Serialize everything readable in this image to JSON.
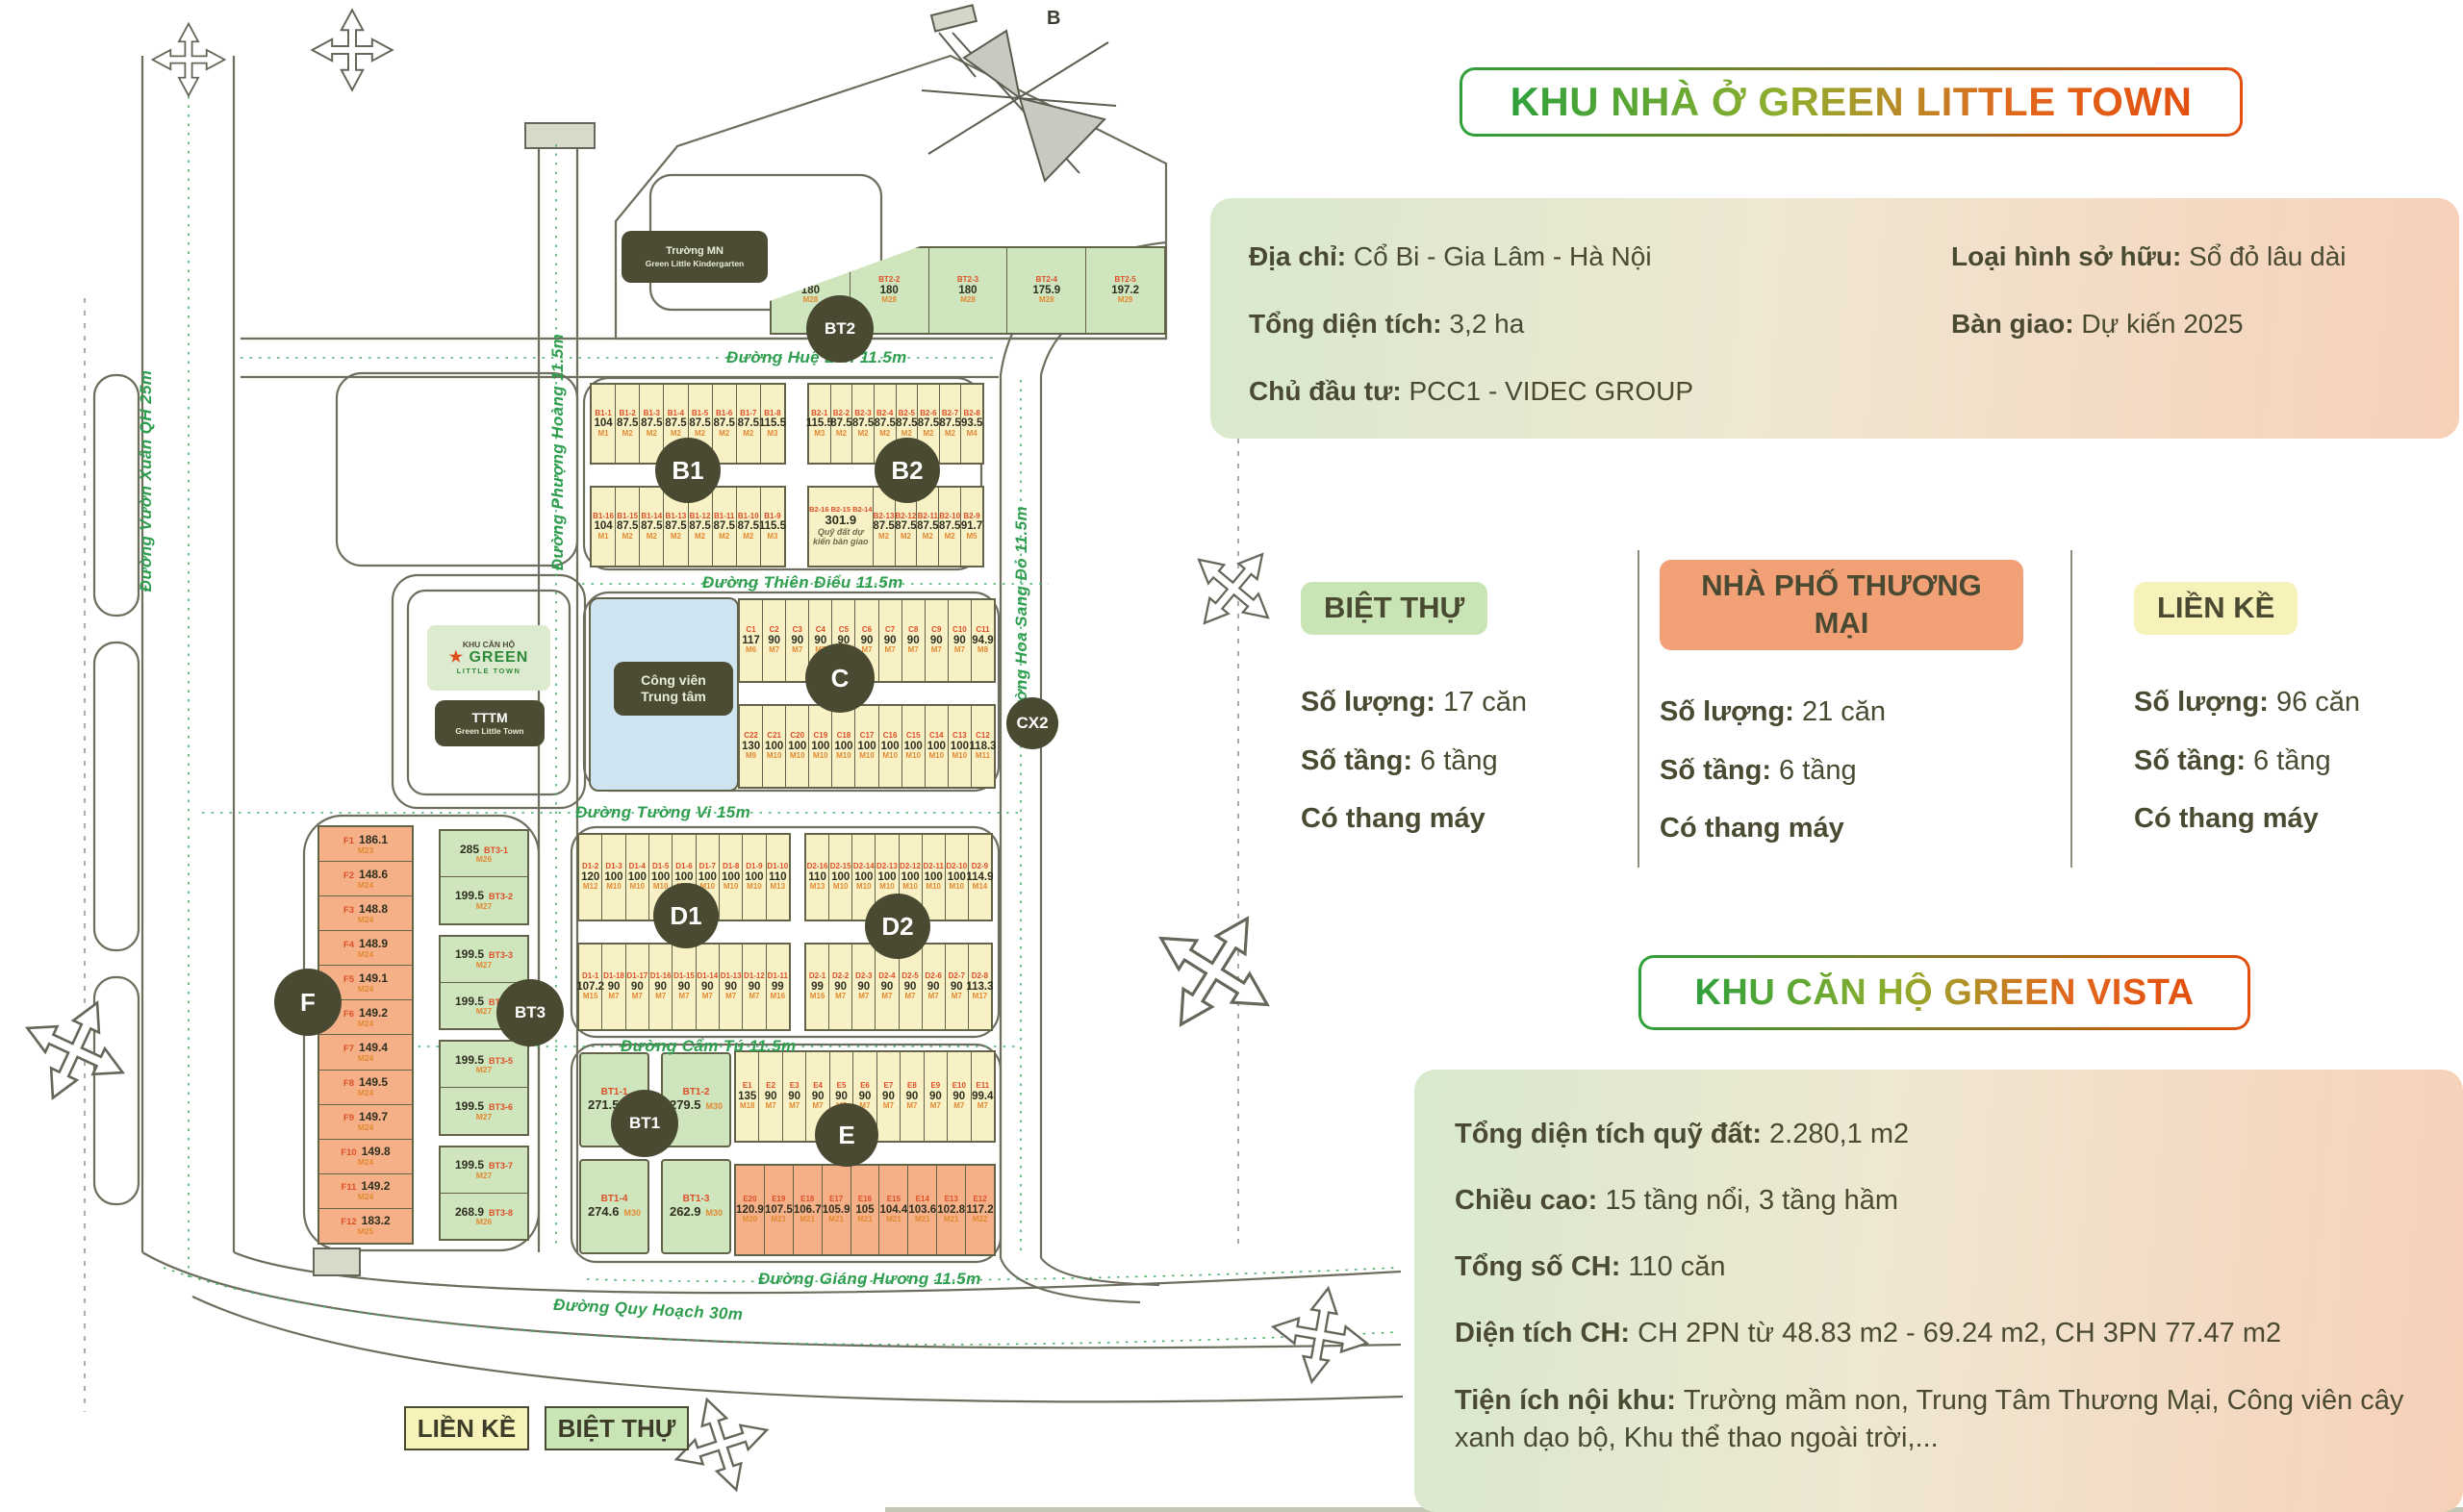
{
  "title_badge": "KHU NHÀ Ở GREEN LITTLE TOWN",
  "info_panel": {
    "rows_left": [
      {
        "label": "Địa chỉ:",
        "value": "Cổ Bi - Gia Lâm - Hà Nội"
      },
      {
        "label": "Tổng diện tích:",
        "value": "3,2 ha"
      },
      {
        "label": "Chủ đầu tư:",
        "value": "PCC1 - VIDEC GROUP"
      }
    ],
    "rows_right": [
      {
        "label": "Loại hình sở hữu:",
        "value": "Sổ đỏ lâu dài"
      },
      {
        "label": "Bàn giao:",
        "value": "Dự kiến 2025"
      }
    ]
  },
  "product_cards": [
    {
      "name": "BIỆT THỰ",
      "badge_color": "#c9e5b5",
      "rows": [
        {
          "label": "Số lượng:",
          "value": "17 căn"
        },
        {
          "label": "Số tầng:",
          "value": "6 tầng"
        }
      ],
      "note": "Có thang máy"
    },
    {
      "name": "NHÀ PHỐ THƯƠNG MẠI",
      "badge_color": "#f2a176",
      "rows": [
        {
          "label": "Số lượng:",
          "value": "21 căn"
        },
        {
          "label": "Số tầng:",
          "value": "6 tầng"
        }
      ],
      "note": "Có thang máy"
    },
    {
      "name": "LIỀN KỀ",
      "badge_color": "#f6f2b9",
      "rows": [
        {
          "label": "Số lượng:",
          "value": "96 căn"
        },
        {
          "label": "Số tầng:",
          "value": "6 tầng"
        }
      ],
      "note": "Có thang máy"
    }
  ],
  "vista": {
    "badge": "KHU CĂN HỘ GREEN VISTA",
    "rows": [
      {
        "label": "Tổng diện tích quỹ đất:",
        "value": "2.280,1 m2"
      },
      {
        "label": "Chiều cao:",
        "value": "15 tầng nổi, 3 tầng hầm"
      },
      {
        "label": "Tổng số CH:",
        "value": "110 căn"
      },
      {
        "label": "Diện tích CH:",
        "value": "CH 2PN từ 48.83 m2 - 69.24 m2, CH 3PN 77.47 m2"
      },
      {
        "label": "Tiện ích nội khu:",
        "value": "Trường mầm non, Trung Tâm Thương Mại, Công viên cây xanh dạo bộ, Khu thể thao ngoài trời,..."
      }
    ]
  },
  "legend": [
    {
      "label": "LIỀN KỀ",
      "color": "#f6f2b9"
    },
    {
      "label": "BIỆT THỰ",
      "color": "#c9e5b5"
    }
  ],
  "map": {
    "compass": "B",
    "kindergarten": {
      "line1": "Trường MN",
      "line2": "Green Little Kindergarten"
    },
    "center_building": {
      "line1": "KHU CĂN HỘ",
      "star": "★",
      "brand": "GREEN",
      "brand2": "LITTLE TOWN",
      "tttm1": "TTTM",
      "tttm2": "Green Little Town"
    },
    "park": {
      "line1": "Công viên",
      "line2": "Trung tâm"
    },
    "roads": [
      "Đường Huệ Lan 11.5m",
      "Đường Thiên Điểu 11.5m",
      "Đường Tường Vi 15m",
      "Đường Cẩm Tú 11.5m",
      "Đường Giáng Hương 11.5m",
      "Đường Quy Hoạch 30m",
      "Đường Phượng Hoàng 11.5m",
      "Đường Vườn Xuân QH 25m",
      "Đường Hoa Sang Đỏ 11.5m"
    ],
    "circles": [
      "B1",
      "B2",
      "C",
      "CX2",
      "D1",
      "D2",
      "E",
      "F",
      "BT3",
      "BT1",
      "BT2"
    ],
    "blocks": {
      "BT2": {
        "lots": [
          {
            "id": "BT2-1",
            "area": "180",
            "code": "M28"
          },
          {
            "id": "BT2-2",
            "area": "180",
            "code": "M28"
          },
          {
            "id": "BT2-3",
            "area": "180",
            "code": "M28"
          },
          {
            "id": "BT2-4",
            "area": "175.9",
            "code": "M28"
          },
          {
            "id": "BT2-5",
            "area": "197.2",
            "code": "M29"
          }
        ]
      },
      "B1": {
        "top": [
          {
            "id": "B1-1",
            "area": "104",
            "code": "M1"
          },
          {
            "id": "B1-2",
            "area": "87.5",
            "code": "M2"
          },
          {
            "id": "B1-3",
            "area": "87.5",
            "code": "M2"
          },
          {
            "id": "B1-4",
            "area": "87.5",
            "code": "M2"
          },
          {
            "id": "B1-5",
            "area": "87.5",
            "code": "M2"
          },
          {
            "id": "B1-6",
            "area": "87.5",
            "code": "M2"
          },
          {
            "id": "B1-7",
            "area": "87.5",
            "code": "M2"
          },
          {
            "id": "B1-8",
            "area": "115.5",
            "code": "M3"
          }
        ],
        "bottom": [
          {
            "id": "B1-16",
            "area": "104",
            "code": "M1"
          },
          {
            "id": "B1-15",
            "area": "87.5",
            "code": "M2"
          },
          {
            "id": "B1-14",
            "area": "87.5",
            "code": "M2"
          },
          {
            "id": "B1-13",
            "area": "87.5",
            "code": "M2"
          },
          {
            "id": "B1-12",
            "area": "87.5",
            "code": "M2"
          },
          {
            "id": "B1-11",
            "area": "87.5",
            "code": "M2"
          },
          {
            "id": "B1-10",
            "area": "87.5",
            "code": "M2"
          },
          {
            "id": "B1-9",
            "area": "115.5",
            "code": "M3"
          }
        ]
      },
      "B2": {
        "top": [
          {
            "id": "B2-1",
            "area": "115.5",
            "code": "M3"
          },
          {
            "id": "B2-2",
            "area": "87.5",
            "code": "M2"
          },
          {
            "id": "B2-3",
            "area": "87.5",
            "code": "M2"
          },
          {
            "id": "B2-4",
            "area": "87.5",
            "code": "M2"
          },
          {
            "id": "B2-5",
            "area": "87.5",
            "code": "M2"
          },
          {
            "id": "B2-6",
            "area": "87.5",
            "code": "M2"
          },
          {
            "id": "B2-7",
            "area": "87.5",
            "code": "M2"
          },
          {
            "id": "B2-8",
            "area": "93.5",
            "code": "M4"
          }
        ],
        "bottom": [
          {
            "ids": "B2-16 B2-15 B2-14",
            "area": "301.9",
            "note": "Quỹ đất dự kiến bàn giao"
          },
          {
            "id": "B2-13",
            "area": "87.5",
            "code": "M2"
          },
          {
            "id": "B2-12",
            "area": "87.5",
            "code": "M2"
          },
          {
            "id": "B2-11",
            "area": "87.5",
            "code": "M2"
          },
          {
            "id": "B2-10",
            "area": "87.5",
            "code": "M2"
          },
          {
            "id": "B2-9",
            "area": "91.7",
            "code": "M5"
          }
        ]
      },
      "C": {
        "top": [
          {
            "id": "C1",
            "area": "117",
            "code": "M6"
          },
          {
            "id": "C2",
            "area": "90",
            "code": "M7"
          },
          {
            "id": "C3",
            "area": "90",
            "code": "M7"
          },
          {
            "id": "C4",
            "area": "90",
            "code": "M7"
          },
          {
            "id": "C5",
            "area": "90",
            "code": "M7"
          },
          {
            "id": "C6",
            "area": "90",
            "code": "M7"
          },
          {
            "id": "C7",
            "area": "90",
            "code": "M7"
          },
          {
            "id": "C8",
            "area": "90",
            "code": "M7"
          },
          {
            "id": "C9",
            "area": "90",
            "code": "M7"
          },
          {
            "id": "C10",
            "area": "90",
            "code": "M7"
          },
          {
            "id": "C11",
            "area": "94.9",
            "code": "M8"
          }
        ],
        "bottom": [
          {
            "id": "C22",
            "area": "130",
            "code": "M9"
          },
          {
            "id": "C21",
            "area": "100",
            "code": "M10"
          },
          {
            "id": "C20",
            "area": "100",
            "code": "M10"
          },
          {
            "id": "C19",
            "area": "100",
            "code": "M10"
          },
          {
            "id": "C18",
            "area": "100",
            "code": "M10"
          },
          {
            "id": "C17",
            "area": "100",
            "code": "M10"
          },
          {
            "id": "C16",
            "area": "100",
            "code": "M10"
          },
          {
            "id": "C15",
            "area": "100",
            "code": "M10"
          },
          {
            "id": "C14",
            "area": "100",
            "code": "M10"
          },
          {
            "id": "C13",
            "area": "100",
            "code": "M10"
          },
          {
            "id": "C12",
            "area": "118.3",
            "code": "M11"
          }
        ]
      },
      "D1": {
        "top": [
          {
            "id": "D1-2",
            "area": "120",
            "code": "M12"
          },
          {
            "id": "D1-3",
            "area": "100",
            "code": "M10"
          },
          {
            "id": "D1-4",
            "area": "100",
            "code": "M10"
          },
          {
            "id": "D1-5",
            "area": "100",
            "code": "M10"
          },
          {
            "id": "D1-6",
            "area": "100",
            "code": "M10"
          },
          {
            "id": "D1-7",
            "area": "100",
            "code": "M10"
          },
          {
            "id": "D1-8",
            "area": "100",
            "code": "M10"
          },
          {
            "id": "D1-9",
            "area": "100",
            "code": "M10"
          },
          {
            "id": "D1-10",
            "area": "110",
            "code": "M13"
          }
        ],
        "bottom": [
          {
            "id": "D1-1",
            "area": "107.2",
            "code": "M15"
          },
          {
            "id": "D1-18",
            "area": "90",
            "code": "M7"
          },
          {
            "id": "D1-17",
            "area": "90",
            "code": "M7"
          },
          {
            "id": "D1-16",
            "area": "90",
            "code": "M7"
          },
          {
            "id": "D1-15",
            "area": "90",
            "code": "M7"
          },
          {
            "id": "D1-14",
            "area": "90",
            "code": "M7"
          },
          {
            "id": "D1-13",
            "area": "90",
            "code": "M7"
          },
          {
            "id": "D1-12",
            "area": "90",
            "code": "M7"
          },
          {
            "id": "D1-11",
            "area": "99",
            "code": "M16"
          }
        ]
      },
      "D2": {
        "top": [
          {
            "id": "D2-16",
            "area": "110",
            "code": "M13"
          },
          {
            "id": "D2-15",
            "area": "100",
            "code": "M10"
          },
          {
            "id": "D2-14",
            "area": "100",
            "code": "M10"
          },
          {
            "id": "D2-13",
            "area": "100",
            "code": "M10"
          },
          {
            "id": "D2-12",
            "area": "100",
            "code": "M10"
          },
          {
            "id": "D2-11",
            "area": "100",
            "code": "M10"
          },
          {
            "id": "D2-10",
            "area": "100",
            "code": "M10"
          },
          {
            "id": "D2-9",
            "area": "114.9",
            "code": "M14"
          }
        ],
        "bottom": [
          {
            "id": "D2-1",
            "area": "99",
            "code": "M16"
          },
          {
            "id": "D2-2",
            "area": "90",
            "code": "M7"
          },
          {
            "id": "D2-3",
            "area": "90",
            "code": "M7"
          },
          {
            "id": "D2-4",
            "area": "90",
            "code": "M7"
          },
          {
            "id": "D2-5",
            "area": "90",
            "code": "M7"
          },
          {
            "id": "D2-6",
            "area": "90",
            "code": "M7"
          },
          {
            "id": "D2-7",
            "area": "90",
            "code": "M7"
          },
          {
            "id": "D2-8",
            "area": "113.3",
            "code": "M17"
          }
        ]
      },
      "E": {
        "top": [
          {
            "id": "E1",
            "area": "135",
            "code": "M18"
          },
          {
            "id": "E2",
            "area": "90",
            "code": "M7"
          },
          {
            "id": "E3",
            "area": "90",
            "code": "M7"
          },
          {
            "id": "E4",
            "area": "90",
            "code": "M7"
          },
          {
            "id": "E5",
            "area": "90",
            "code": "M7"
          },
          {
            "id": "E6",
            "area": "90",
            "code": "M7"
          },
          {
            "id": "E7",
            "area": "90",
            "code": "M7"
          },
          {
            "id": "E8",
            "area": "90",
            "code": "M7"
          },
          {
            "id": "E9",
            "area": "90",
            "code": "M7"
          },
          {
            "id": "E10",
            "area": "90",
            "code": "M7"
          },
          {
            "id": "E11",
            "area": "99.4",
            "code": "M7"
          }
        ],
        "bottom": [
          {
            "id": "E20",
            "area": "120.9",
            "code": "M20"
          },
          {
            "id": "E19",
            "area": "107.5",
            "code": "M21"
          },
          {
            "id": "E18",
            "area": "106.7",
            "code": "M21"
          },
          {
            "id": "E17",
            "area": "105.9",
            "code": "M21"
          },
          {
            "id": "E16",
            "area": "105",
            "code": "M21"
          },
          {
            "id": "E15",
            "area": "104.4",
            "code": "M21"
          },
          {
            "id": "E14",
            "area": "103.6",
            "code": "M21"
          },
          {
            "id": "E13",
            "area": "102.8",
            "code": "M21"
          },
          {
            "id": "E12",
            "area": "117.2",
            "code": "M22"
          }
        ]
      },
      "F": {
        "lots": [
          {
            "id": "F1",
            "area": "186.1",
            "code": "M23"
          },
          {
            "id": "F2",
            "area": "148.6",
            "code": "M24"
          },
          {
            "id": "F3",
            "area": "148.8",
            "code": "M24"
          },
          {
            "id": "F4",
            "area": "148.9",
            "code": "M24"
          },
          {
            "id": "F5",
            "area": "149.1",
            "code": "M24"
          },
          {
            "id": "F6",
            "area": "149.2",
            "code": "M24"
          },
          {
            "id": "F7",
            "area": "149.4",
            "code": "M24"
          },
          {
            "id": "F8",
            "area": "149.5",
            "code": "M24"
          },
          {
            "id": "F9",
            "area": "149.7",
            "code": "M24"
          },
          {
            "id": "F10",
            "area": "149.8",
            "code": "M24"
          },
          {
            "id": "F11",
            "area": "149.2",
            "code": "M24"
          },
          {
            "id": "F12",
            "area": "183.2",
            "code": "M25"
          }
        ]
      },
      "BT3": {
        "lots": [
          {
            "id": "BT3-1",
            "area": "285",
            "code": "M26"
          },
          {
            "id": "BT3-2",
            "area": "199.5",
            "code": "M27"
          },
          {
            "id": "BT3-3",
            "area": "199.5",
            "code": "M27"
          },
          {
            "id": "BT3-4",
            "area": "199.5",
            "code": "M27"
          },
          {
            "id": "BT3-5",
            "area": "199.5",
            "code": "M27"
          },
          {
            "id": "BT3-6",
            "area": "199.5",
            "code": "M27"
          },
          {
            "id": "BT3-7",
            "area": "199.5",
            "code": "M27"
          },
          {
            "id": "BT3-8",
            "area": "268.9",
            "code": "M26"
          }
        ]
      },
      "BT1": {
        "lots": [
          {
            "id": "BT1-1",
            "area": "271.5",
            "code": "M30"
          },
          {
            "id": "BT1-2",
            "area": "279.5",
            "code": "M30"
          },
          {
            "id": "BT1-4",
            "area": "274.6",
            "code": "M30"
          },
          {
            "id": "BT1-3",
            "area": "262.9",
            "code": "M30"
          }
        ]
      }
    }
  }
}
